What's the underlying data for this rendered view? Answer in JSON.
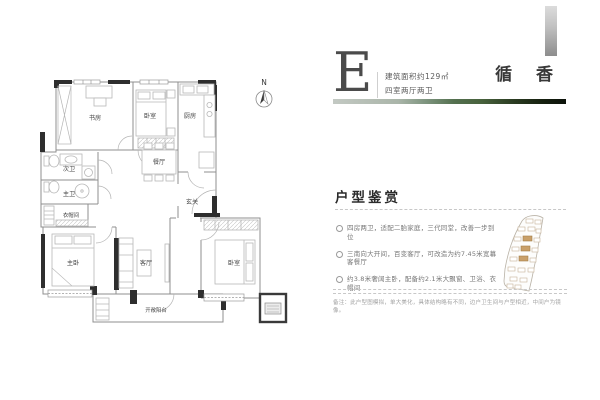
{
  "header": {
    "plan_letter": "E",
    "area_text": "建筑面积约129㎡",
    "layout_text": "四室两厅两卫",
    "project_title": "循 香"
  },
  "floor_plan": {
    "north_label": "N",
    "rooms": {
      "study": "书房",
      "bedroom2": "卧室",
      "kitchen": "厨房",
      "bath2": "次卫",
      "bath1": "主卫",
      "closet": "衣帽间",
      "master": "主卧",
      "dining": "餐厅",
      "entry": "玄关",
      "living": "客厅",
      "bedroom3": "卧室",
      "balcony": "开敞阳台"
    }
  },
  "appreciation": {
    "title": "户型鉴赏",
    "bullets": [
      "四房两卫，适配二胎家庭，三代同堂，改善一步到位",
      "三南向大开间，百变客厅，可改造为约7.45米宽幕客餐厅",
      "约3.8米奢阔主卧，配备约2.1米大飘窗、卫浴、衣帽间"
    ],
    "note": "备注：此户型图模拟，单大美化，具体结构略有不同，边户卫生间与户型相近，中间户为镜像。"
  },
  "colors": {
    "accent_building": "#c9a06a",
    "wall_dark": "#2e2e2e",
    "wall_line": "#8f8f8f",
    "strip_green_dark": "#16200f",
    "strip_green_light": "#c3c9c3",
    "title_gray": "#383838"
  }
}
